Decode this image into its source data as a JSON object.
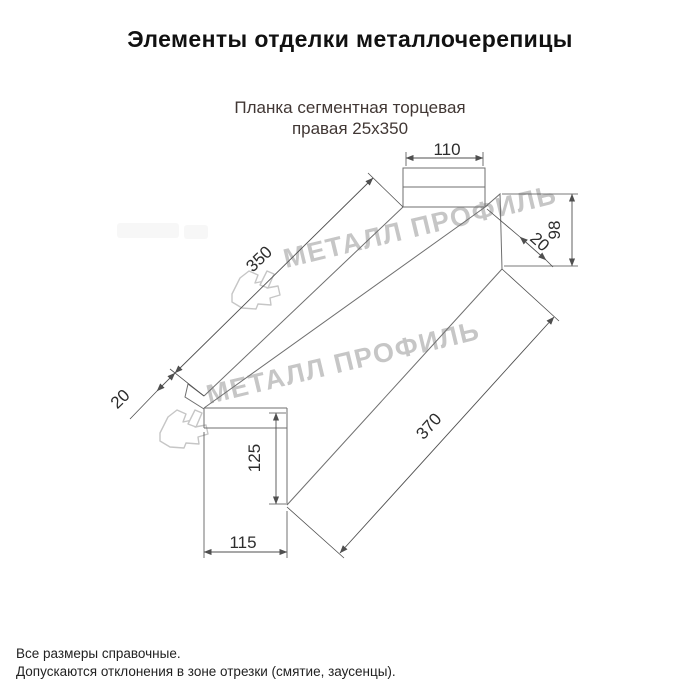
{
  "title": "Элементы отделки металлочерепицы",
  "product": {
    "name_line1": "Планка сегментная торцевая",
    "name_line2": "правая 25х350"
  },
  "dims": {
    "flange_width_top": "110",
    "length_top": "350",
    "hem_left": "20",
    "hem_right": "20",
    "height_right": "98",
    "height_left": "125",
    "flange_width_bottom": "115",
    "length_bottom": "370"
  },
  "watermark": {
    "text": "МЕТАЛЛ ПРОФИЛЬ"
  },
  "footer": {
    "line1": "Все размеры справочные.",
    "line2": "Допускаются отклонения в зоне отрезки (смятие, заусенцы)."
  },
  "colors": {
    "line": "#6f6f6f",
    "dim_text": "#2d2d2d",
    "title": "#111111",
    "subtitle": "#413734",
    "watermark": "#c6c6c6",
    "footer": "#222222"
  }
}
